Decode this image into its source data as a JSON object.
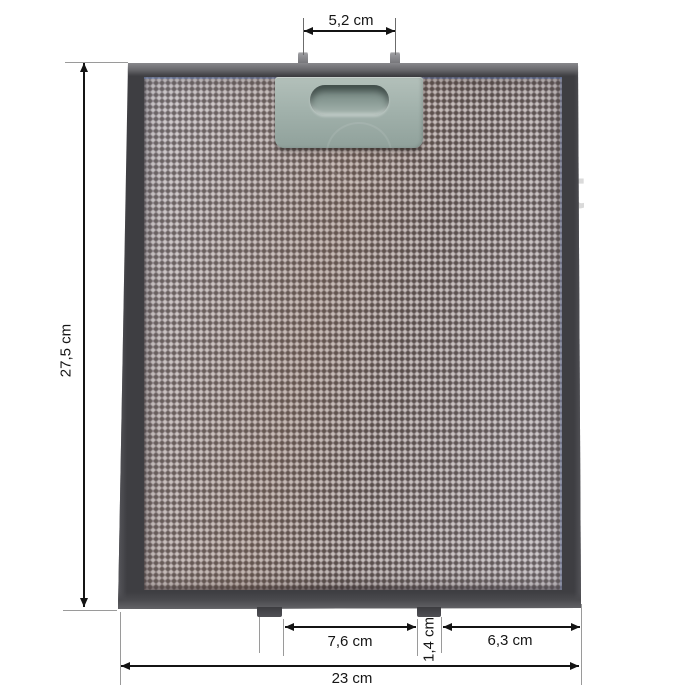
{
  "scene": {
    "subject": "metal-mesh-grease-filter-with-dimensions",
    "background": "#ffffff",
    "watermark_letter": "t"
  },
  "dimensions": {
    "pin_spacing": "5,2 cm",
    "height": "27,5 cm",
    "tab_gap": "7,6 cm",
    "tab_width": "1,4 cm",
    "tab_to_edge": "6,3 cm",
    "width": "23 cm"
  },
  "colors": {
    "frame": "#3e3e42",
    "frame_bevel": "#8d8d91",
    "mesh_base": "#8f8689",
    "mesh_light_dot": "#dcd8d6",
    "mesh_dark_dot": "#4f4744",
    "latch": "#a2b2ac",
    "iridescent_blue": "#5078c3",
    "dimension_line": "#141414",
    "extension_line": "#9a9a9a",
    "watermark": "#dadada"
  }
}
